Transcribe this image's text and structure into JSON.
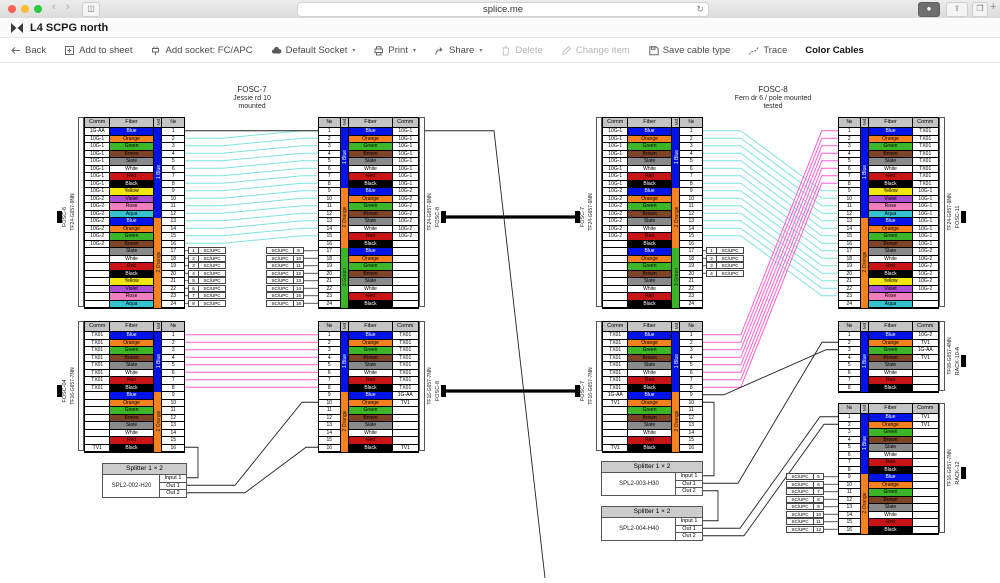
{
  "browser": {
    "url": "splice.me",
    "icons": [
      "back-chevron",
      "forward-chevron",
      "sidebar-toggle",
      "refresh",
      "downloads",
      "share",
      "tabs",
      "new-tab"
    ]
  },
  "window": {
    "title": "L4 SCPG north",
    "logo": "splice-bowtie-icon"
  },
  "toolbar": {
    "items": [
      {
        "name": "back",
        "label": "Back",
        "icon": "arrow-left",
        "caret": false,
        "disabled": false,
        "emph": false
      },
      {
        "name": "add-to-sheet",
        "label": "Add to sheet",
        "icon": "square-plus",
        "caret": false,
        "disabled": false,
        "emph": false
      },
      {
        "name": "add-socket",
        "label": "Add socket: FC/APC",
        "icon": "socket",
        "caret": false,
        "disabled": false,
        "emph": false
      },
      {
        "name": "default-socket",
        "label": "Default Socket",
        "icon": "cloud",
        "caret": true,
        "disabled": false,
        "emph": false
      },
      {
        "name": "print",
        "label": "Print",
        "icon": "printer",
        "caret": true,
        "disabled": false,
        "emph": false
      },
      {
        "name": "share",
        "label": "Share",
        "icon": "share",
        "caret": true,
        "disabled": false,
        "emph": false
      },
      {
        "name": "delete",
        "label": "Delete",
        "icon": "trash",
        "caret": false,
        "disabled": true,
        "emph": false
      },
      {
        "name": "change-item",
        "label": "Change item",
        "icon": "pencil",
        "caret": false,
        "disabled": true,
        "emph": false
      },
      {
        "name": "save-cable-type",
        "label": "Save cable type",
        "icon": "floppy",
        "caret": false,
        "disabled": false,
        "emph": false
      },
      {
        "name": "trace",
        "label": "Trace",
        "icon": "trace",
        "caret": false,
        "disabled": false,
        "emph": false
      },
      {
        "name": "color-cables",
        "label": "Color Cables",
        "icon": null,
        "caret": false,
        "disabled": false,
        "emph": true
      }
    ]
  },
  "headers": {
    "comm": "Comm",
    "fiber": "Fiber",
    "md": "Md",
    "num": "№"
  },
  "fiber_palette": [
    {
      "name": "Blue",
      "hex": "#0013e6",
      "text": "#ffffff"
    },
    {
      "name": "Orange",
      "hex": "#f5821f",
      "text": "#000000"
    },
    {
      "name": "Green",
      "hex": "#3db528",
      "text": "#000000"
    },
    {
      "name": "Brown",
      "hex": "#7d4427",
      "text": "#000000"
    },
    {
      "name": "Slate",
      "hex": "#8a8a8a",
      "text": "#000000"
    },
    {
      "name": "White",
      "hex": "#ffffff",
      "text": "#000000"
    },
    {
      "name": "Red",
      "hex": "#c81414",
      "text": "#000000"
    },
    {
      "name": "Black",
      "hex": "#000000",
      "text": "#ffffff"
    },
    {
      "name": "Yellow",
      "hex": "#f2e50e",
      "text": "#000000"
    },
    {
      "name": "Violet",
      "hex": "#ad4fd4",
      "text": "#000000"
    },
    {
      "name": "Rose",
      "hex": "#f07fc0",
      "text": "#000000"
    },
    {
      "name": "Aqua",
      "hex": "#35c4cf",
      "text": "#000000"
    }
  ],
  "tube_colors": {
    "1 Blue": "#0013e6",
    "2 Orange": "#f5821f",
    "3 Green": "#3db528"
  },
  "tube_text": {
    "1 Blue": "#ffffff",
    "2 Orange": "#1a1a1a",
    "3 Green": "#1a1a1a"
  },
  "trace_colors": {
    "cyan": "#7fe2e2",
    "magenta": "#ff5fd0"
  },
  "closure_titles": [
    {
      "cx": 252,
      "y": 86,
      "lines": [
        "FOSC-7",
        "Jessie rd 10",
        "mounted"
      ]
    },
    {
      "cx": 773,
      "y": 86,
      "lines": [
        "FOSC-8",
        "Fern dr 6 / pole mounted",
        "tested"
      ]
    }
  ],
  "tables": [
    {
      "id": "A",
      "x": 84,
      "y": 117,
      "side": "left",
      "rows": 24,
      "tubes": [
        {
          "label": "1 Blue",
          "count": 12
        },
        {
          "label": "2 Orange",
          "count": 12
        }
      ],
      "comms": {
        "1": "1G-AA",
        "2-9": "10G-1",
        "10-16": "10G-2"
      },
      "cable": "TF24-G657-9NN",
      "dest": "FOSC-6"
    },
    {
      "id": "B",
      "x": 318,
      "y": 117,
      "side": "right",
      "rows": 24,
      "tubes": [
        {
          "label": "1 Blue",
          "count": 8
        },
        {
          "label": "2 Orange",
          "count": 8
        },
        {
          "label": "3 Green",
          "count": 8
        }
      ],
      "comms": {
        "1-8": "10G-1",
        "9-15": "10G-2"
      },
      "cable": "TF24-G657-9NN",
      "dest": "FOSC-8"
    },
    {
      "id": "C",
      "x": 84,
      "y": 321,
      "side": "left",
      "rows": 16,
      "tubes": [
        {
          "label": "1 Blue",
          "count": 8
        },
        {
          "label": "2 Orange",
          "count": 8
        }
      ],
      "comms": {
        "1-8": "TX01",
        "16": "TV1"
      },
      "cable": "TF16-G657-7NN",
      "dest": "FOSC-04"
    },
    {
      "id": "D",
      "x": 318,
      "y": 321,
      "side": "right",
      "rows": 16,
      "tubes": [
        {
          "label": "1 Blue",
          "count": 8
        },
        {
          "label": "2 Orange",
          "count": 8
        }
      ],
      "comms": {
        "1-8": "TX01",
        "9": "1G-AA",
        "10": "TV1",
        "16": "TV1"
      },
      "cable": "TF16-G657-7NN",
      "dest": "FOSC-8"
    },
    {
      "id": "E",
      "x": 602,
      "y": 117,
      "side": "left",
      "rows": 24,
      "tubes": [
        {
          "label": "1 Blue",
          "count": 8
        },
        {
          "label": "2 Orange",
          "count": 8
        },
        {
          "label": "3 Green",
          "count": 8
        }
      ],
      "comms": {
        "1-8": "10G-1",
        "9-15": "10G-2"
      },
      "cable": "TF24-G657-9NN",
      "dest": "FOSC-7"
    },
    {
      "id": "F",
      "x": 602,
      "y": 321,
      "side": "left",
      "rows": 16,
      "tubes": [
        {
          "label": "1 Blue",
          "count": 8
        },
        {
          "label": "2 Orange",
          "count": 8
        }
      ],
      "comms": {
        "1-8": "TX01",
        "9": "1G-AA",
        "10": "TV1",
        "16": "TV1"
      },
      "cable": "TF16-G657-7NN",
      "dest": "FOSC-7"
    },
    {
      "id": "G",
      "x": 838,
      "y": 117,
      "side": "right",
      "rows": 24,
      "tubes": [
        {
          "label": "1 Blue",
          "count": 12
        },
        {
          "label": "2 Orange",
          "count": 12
        }
      ],
      "comms": {
        "1-8": "TX01",
        "9-16": "10G-1",
        "17-22": "10G-2"
      },
      "cable": "TF24-G657-9NN",
      "dest": "FOSC-11"
    },
    {
      "id": "H",
      "x": 838,
      "y": 321,
      "side": "right",
      "rows": 8,
      "tubes": [
        {
          "label": "1 Blue",
          "count": 8
        }
      ],
      "comms": {
        "1": "10G-2",
        "2": "TV1",
        "3": "1G-AA",
        "4": "TV1"
      },
      "cable": "TF08-G657-4NN",
      "dest": "RACK-10-A"
    },
    {
      "id": "I",
      "x": 838,
      "y": 403,
      "side": "right",
      "rows": 16,
      "tubes": [
        {
          "label": "1 Blue",
          "count": 8
        },
        {
          "label": "2 Orange",
          "count": 8
        }
      ],
      "comms": {
        "1": "TV1",
        "2": "TV1"
      },
      "cable": "TF16-G657-7NN",
      "dest": "RACK-12"
    }
  ],
  "socket_label": "SC/UPC",
  "sockets": [
    {
      "table": "A",
      "rows": [
        17,
        24
      ],
      "start": 1,
      "num_first": true
    },
    {
      "table": "B",
      "rows": [
        17,
        24
      ],
      "start": 9,
      "num_first": false
    },
    {
      "table": "E",
      "rows": [
        17,
        20
      ],
      "start": 1,
      "num_first": true
    },
    {
      "table": "I",
      "rows": [
        9,
        16
      ],
      "start": 5,
      "num_first": false
    }
  ],
  "splitters": [
    {
      "id": "SPL2-002-H20",
      "x": 102,
      "y": 463,
      "w": 85,
      "title": "Splitter 1 × 2",
      "model": "SPL2-002-H20",
      "ports": [
        "Input 1",
        "Out 1",
        "Out 2"
      ]
    },
    {
      "id": "SPL2-003-H30",
      "x": 601,
      "y": 461,
      "w": 102,
      "title": "Splitter 1 × 2",
      "model": "SPL2-003-H30",
      "ports": [
        "Input 1",
        "Out 1",
        "Out 2"
      ]
    },
    {
      "id": "SPL2-004-H40",
      "x": 601,
      "y": 506,
      "w": 102,
      "title": "Splitter 1 × 2",
      "model": "SPL2-004-H40",
      "ports": [
        "Input 1",
        "Out 1",
        "Out 2"
      ]
    }
  ],
  "traces": [
    {
      "color": "cyan",
      "from": "A",
      "rows": [
        2,
        16
      ],
      "to": "B",
      "to_start": 1
    },
    {
      "color": "magenta",
      "from": "C",
      "rows": [
        1,
        8
      ],
      "to": "D",
      "to_start": 1
    },
    {
      "color": "cyan",
      "from": "E",
      "rows": [
        1,
        15
      ],
      "to": "G",
      "to_start": 9
    },
    {
      "color": "magenta",
      "from": "F",
      "rows": [
        1,
        8
      ],
      "to": "G",
      "to_start": 1
    }
  ],
  "trunks": [
    [
      "B",
      "E"
    ],
    [
      "D",
      "F"
    ]
  ]
}
